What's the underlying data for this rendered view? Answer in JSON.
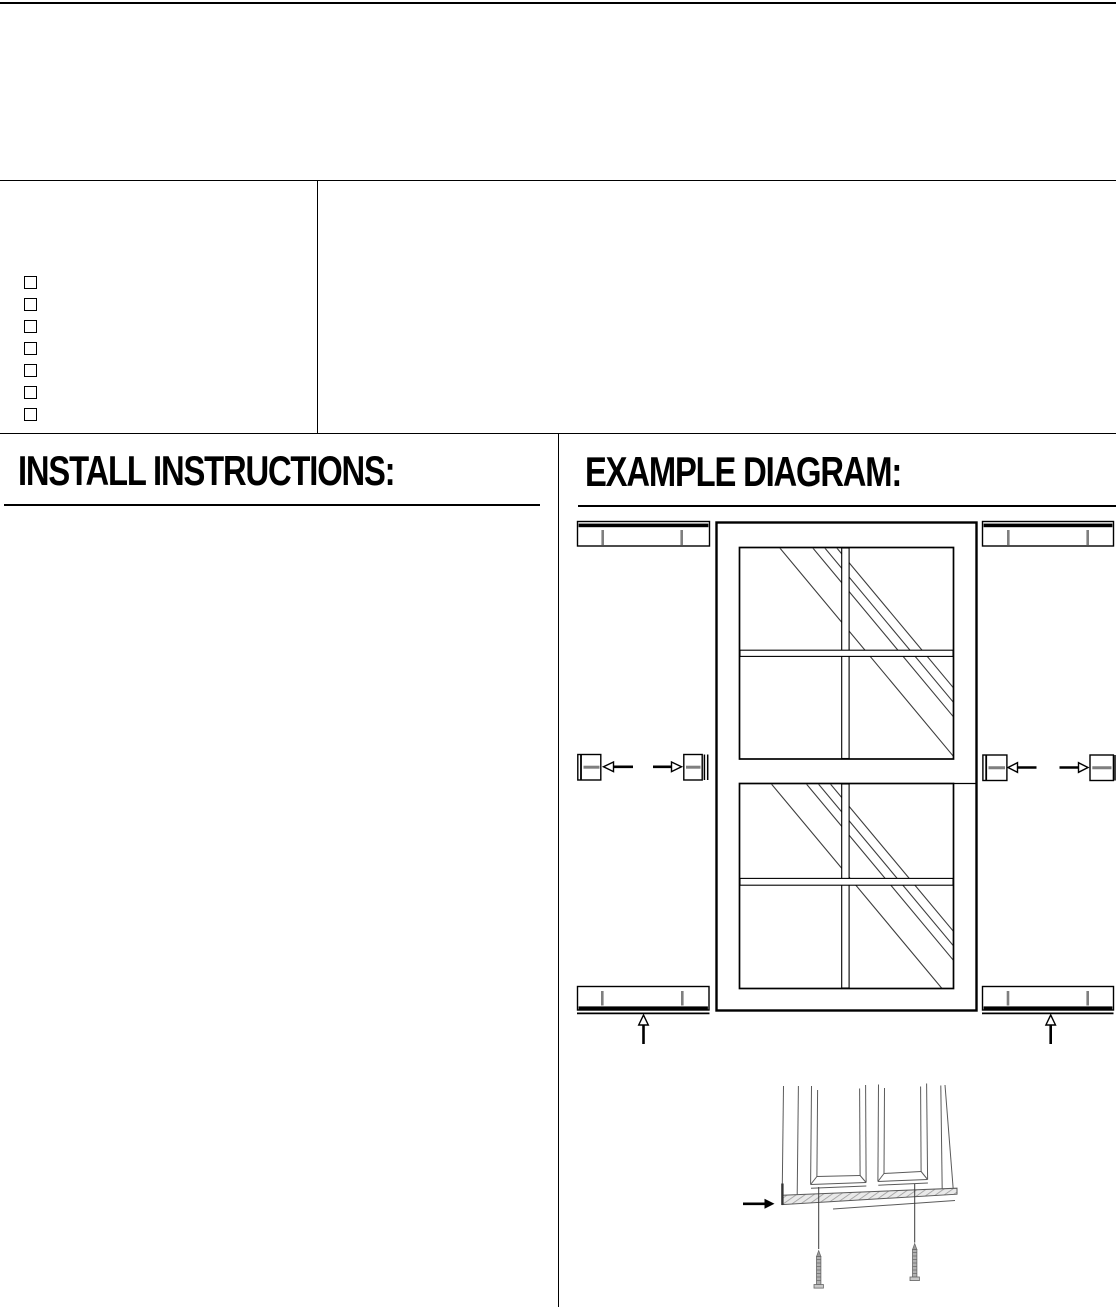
{
  "colors": {
    "background": "#ffffff",
    "ink": "#000000",
    "hardware_gray": "#7f7f7f",
    "drawing_gray": "#5a5a5a"
  },
  "top_section": {
    "checklist": {
      "items": [
        {
          "checked": false,
          "label": ""
        },
        {
          "checked": false,
          "label": ""
        },
        {
          "checked": false,
          "label": ""
        },
        {
          "checked": false,
          "label": ""
        },
        {
          "checked": false,
          "label": ""
        },
        {
          "checked": false,
          "label": ""
        },
        {
          "checked": false,
          "label": ""
        }
      ]
    }
  },
  "instructions_panel": {
    "heading": "INSTALL INSTRUCTIONS:"
  },
  "diagram_panel": {
    "heading": "EXAMPLE DIAGRAM:",
    "parts": [
      "top-mounting-rail-left",
      "top-mounting-rail-right",
      "double-hung-window",
      "side-bracket-pair-left",
      "side-bracket-pair-right",
      "bottom-mounting-rail-left",
      "bottom-mounting-rail-right",
      "shutter-bottom-closeup",
      "mounting-screws"
    ]
  }
}
